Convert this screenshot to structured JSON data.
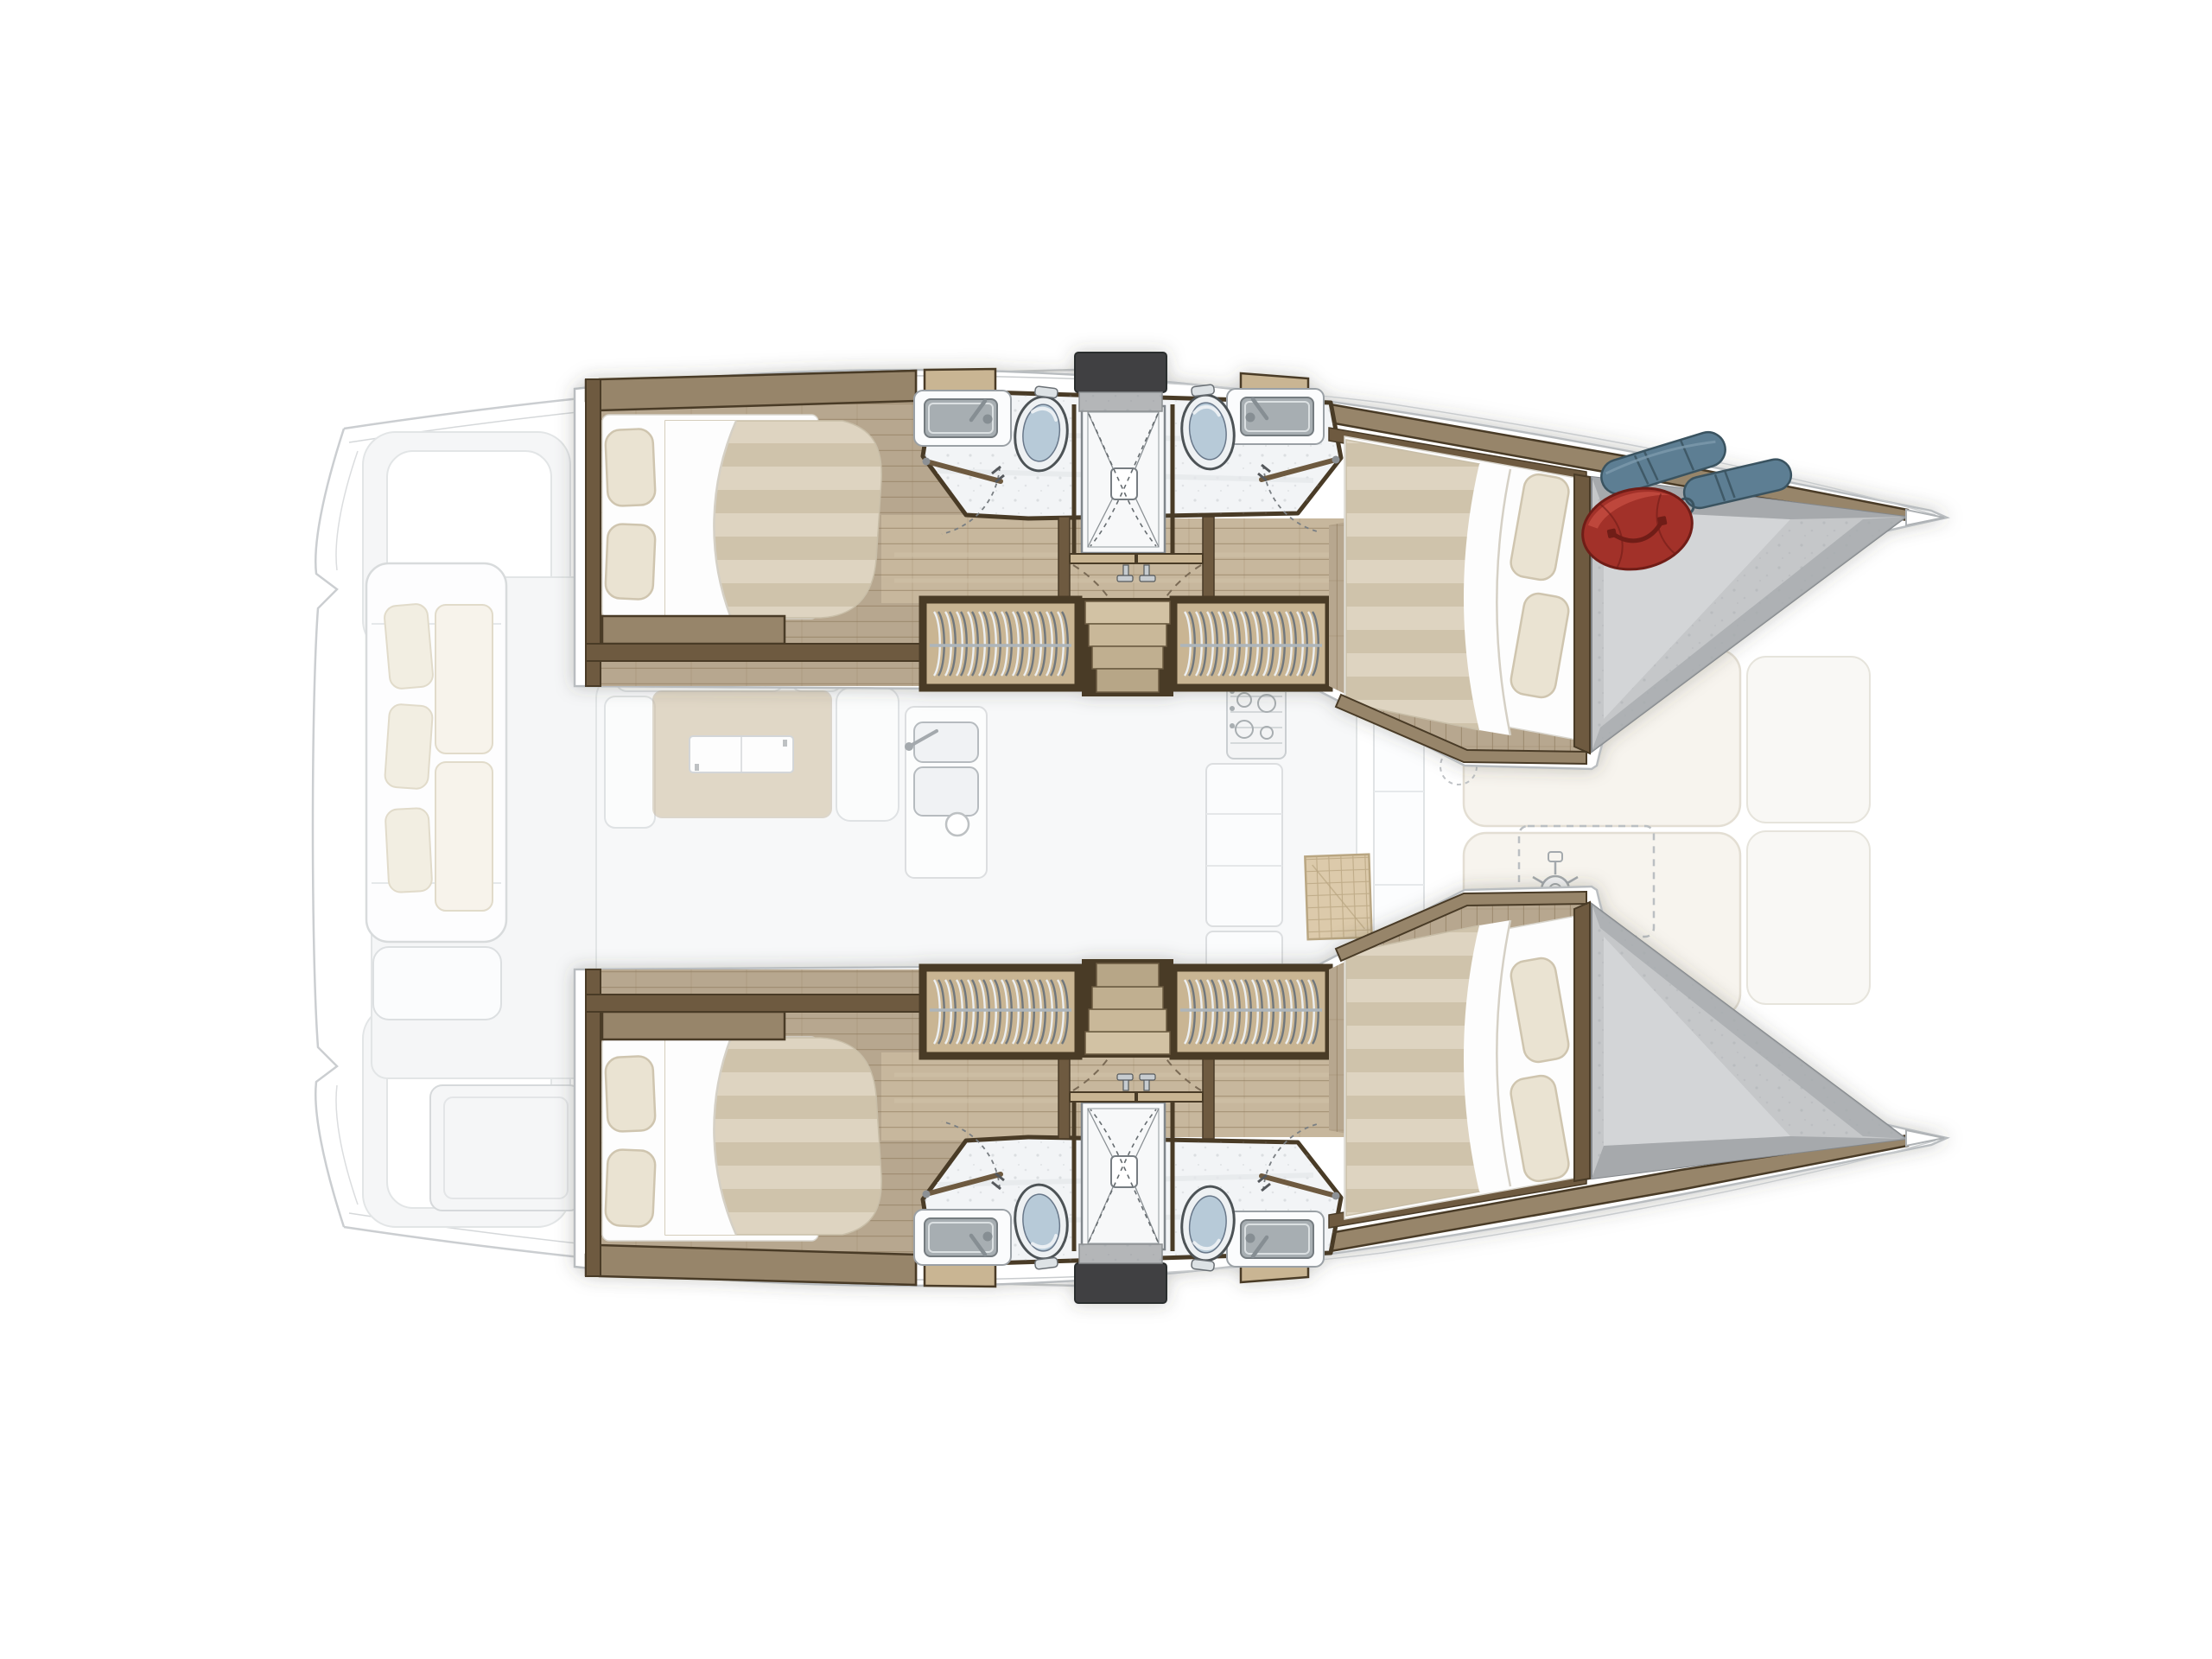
{
  "meta": {
    "title": "Catamaran interior layout floor plan",
    "type": "boat-floor-plan",
    "orientation": "bow-right",
    "visible_text": "none"
  },
  "colors": {
    "white": "#ffffff",
    "ghostLine": "#c6c9cc",
    "ghostStroke": "#dfe2e4",
    "ghostFill": "#f4f5f6",
    "woodDark": "#4a3b28",
    "woodFrame": "#6e5a40",
    "woodMid": "#97856a",
    "tan": "#c9b593",
    "floor": "#b7a78f",
    "floorLight": "#c7b79d",
    "plank": "#8a7557",
    "bathFloor": "#f2f4f6",
    "counter": "#fbfcfd",
    "basin": "#a7aeb2",
    "steel": "#868e93",
    "toiletLid": "#b7cad8",
    "toiletLine": "#4d5357",
    "stripeA": "#ded4c1",
    "stripeB": "#cfc3ab",
    "sheet": "#fdfdfd",
    "pillow": "#eae3d2",
    "pillowLine": "#cfc5af",
    "hatch": "#3f4142",
    "speckStrip": "#b4b6b8",
    "speckle": "#8f959a",
    "foreGray": "#c5c7c9",
    "foreGrayDark": "#a6a9ac",
    "foreFloor": "#d3d5d7",
    "fender": "#5d7e93",
    "fenderDark": "#3a5360",
    "bag": "#a23129",
    "bagDark": "#701d17",
    "bagLight": "#c14a3e",
    "cream": "#f1ecdf",
    "creamLine": "#ded7c5",
    "matTan": "#d8c5a2",
    "matLine": "#b19b73"
  },
  "vessel": {
    "style": "catamaran",
    "port_hull": {
      "aft_cabin": {
        "furniture": [
          "double-bed",
          "pillow",
          "pillow",
          "footboard-shelf"
        ]
      },
      "bathrooms": [
        {
          "fixtures": [
            "sink-with-faucet",
            "toilet",
            "door"
          ]
        },
        {
          "fixtures": [
            "sink-with-faucet",
            "toilet",
            "door"
          ]
        }
      ],
      "shower": {
        "fixtures": [
          "shower-tray",
          "drain",
          "folding-door"
        ]
      },
      "corridor": {
        "features": [
          "double-doors",
          "wardrobe-hanging-locker",
          "companionway-stairs",
          "wardrobe-hanging-locker"
        ]
      },
      "forward_cabin": {
        "furniture": [
          "double-bed",
          "pillow",
          "pillow"
        ]
      },
      "forepeak": {
        "contents": [
          "blue-fender",
          "blue-fender",
          "red-duffel-bag"
        ]
      }
    },
    "starboard_hull": {
      "mirrored_of": "port_hull",
      "forepeak": {
        "contents": []
      }
    },
    "main_deck_ghosted": {
      "aft_cockpit": [
        "transom-steps",
        "sofa-with-cushions",
        "storage-pocket",
        "deck-seat"
      ],
      "saloon": [
        "bench-seats",
        "dining-table",
        "sliding-tabletop",
        "chaise",
        "galley-double-sink",
        "cup",
        "stove",
        "cabinets",
        "aft-bench"
      ],
      "foredeck": [
        "front-window-band",
        "sunpad",
        "sunpad",
        "side-pads",
        "woven-mat",
        "windlass-area-dashed",
        "hatch-circle-dashed"
      ]
    }
  }
}
